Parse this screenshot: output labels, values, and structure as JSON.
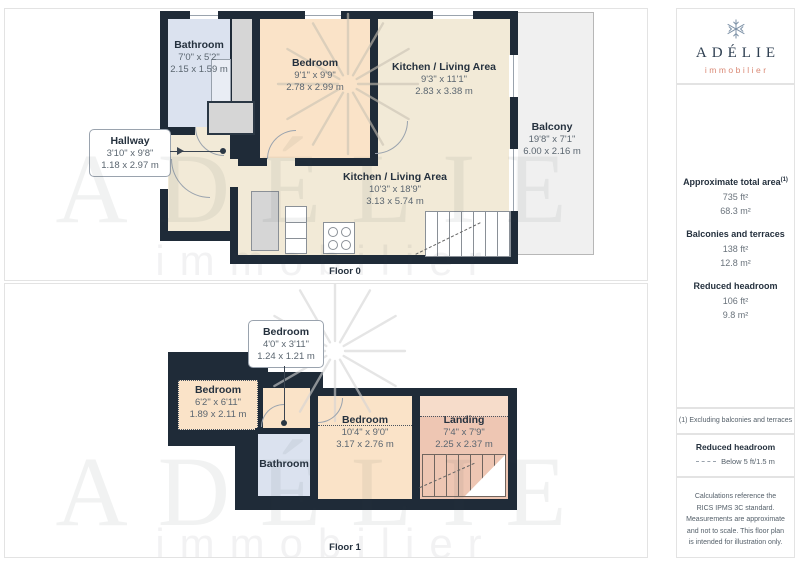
{
  "colors": {
    "wall": "#1f2b38",
    "cream": "#f2ead7",
    "peach": "#fae3c8",
    "blue": "#dbe2ef",
    "salmon": "#eec6b3",
    "salmon_light": "#f6dcca",
    "balcony": "#f0f0f0",
    "navy": "#25313e",
    "dim": "#5b6670",
    "accent": "#d98874"
  },
  "watermark": {
    "brand": "ADÉLIE",
    "tagline": "immobilier"
  },
  "floor0": {
    "label": "Floor 0",
    "rooms": {
      "bathroom": {
        "name": "Bathroom",
        "ft": "7'0\" x 5'2\"",
        "m": "2.15 x 1.59 m"
      },
      "bedroom": {
        "name": "Bedroom",
        "ft": "9'1\" x 9'9\"",
        "m": "2.78 x 2.99 m"
      },
      "kitchen_top": {
        "name": "Kitchen / Living Area",
        "ft": "9'3\" x 11'1\"",
        "m": "2.83 x 3.38 m"
      },
      "kitchen_main": {
        "name": "Kitchen / Living Area",
        "ft": "10'3\" x 18'9\"",
        "m": "3.13 x 5.74 m"
      },
      "hallway": {
        "name": "Hallway",
        "ft": "3'10\" x 9'8\"",
        "m": "1.18 x 2.97 m"
      },
      "balcony": {
        "name": "Balcony",
        "ft": "19'8\" x 7'1\"",
        "m": "6.00 x 2.16 m"
      }
    }
  },
  "floor1": {
    "label": "Floor 1",
    "rooms": {
      "bedroom_small": {
        "name": "Bedroom",
        "ft": "4'0\" x 3'11\"",
        "m": "1.24 x 1.21 m"
      },
      "bedroom_left": {
        "name": "Bedroom",
        "ft": "6'2\" x 6'11\"",
        "m": "1.89 x 2.11 m"
      },
      "bedroom_mid": {
        "name": "Bedroom",
        "ft": "10'4\" x 9'0\"",
        "m": "3.17 x 2.76 m"
      },
      "bathroom": {
        "name": "Bathroom"
      },
      "landing": {
        "name": "Landing",
        "ft": "7'4\" x 7'9\"",
        "m": "2.25 x 2.37 m"
      }
    }
  },
  "sidebar": {
    "logo": {
      "brand": "ADÉLIE",
      "tagline": "immobilier"
    },
    "areas": [
      {
        "label": "Approximate total area",
        "ref": "(1)",
        "ft": "735 ft²",
        "m": "68.3 m²"
      },
      {
        "label": "Balconies and terraces",
        "ft": "138 ft²",
        "m": "12.8 m²"
      },
      {
        "label": "Reduced headroom",
        "ft": "106 ft²",
        "m": "9.8 m²"
      }
    ],
    "footnote": "(1) Excluding balconies and terraces",
    "legend": {
      "title": "Reduced headroom",
      "item": "Below 5 ft/1.5 m"
    },
    "disclaimer": "Calculations reference the RICS IPMS 3C standard. Measurements are approximate and not to scale. This floor plan is intended for illustration only.",
    "credit": {
      "name": "GIRAFFE",
      "bold": "360"
    }
  }
}
